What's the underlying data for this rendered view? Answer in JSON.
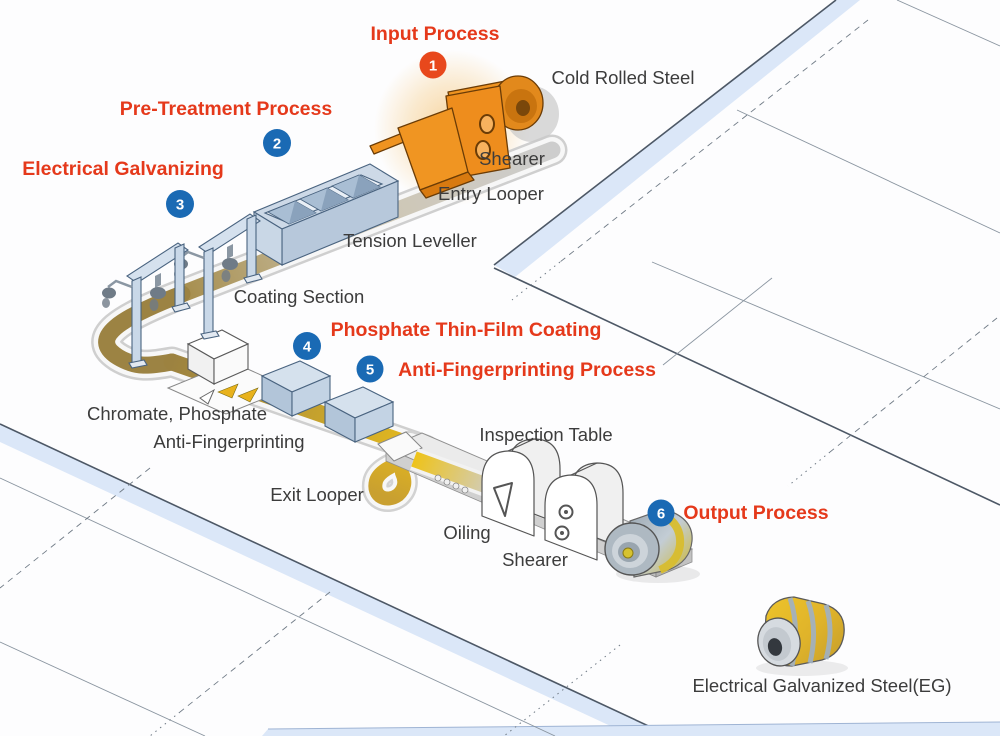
{
  "steps": [
    {
      "number": "1",
      "label": "Input Process",
      "badge_color": "#e8481c"
    },
    {
      "number": "2",
      "label": "Pre-Treatment Process",
      "badge_color": "#1a6ab4"
    },
    {
      "number": "3",
      "label": "Electrical Galvanizing",
      "badge_color": "#1a6ab4"
    },
    {
      "number": "4",
      "label": "Phosphate Thin-Film Coating",
      "badge_color": "#1a6ab4"
    },
    {
      "number": "5",
      "label": "Anti-Fingerprinting Process",
      "badge_color": "#1a6ab4"
    },
    {
      "number": "6",
      "label": "Output Process",
      "badge_color": "#1a6ab4"
    }
  ],
  "equipment": {
    "cold_rolled_steel": "Cold Rolled Steel",
    "shearer_entry": "Shearer",
    "entry_looper": "Entry Looper",
    "tension_leveller": "Tension Leveller",
    "coating_section": "Coating Section",
    "chromate_phosphate": "Chromate, Phosphate",
    "anti_fingerprinting": "Anti-Fingerprinting",
    "exit_looper": "Exit Looper",
    "inspection_table": "Inspection Table",
    "oiling": "Oiling",
    "shearer_exit": "Shearer",
    "eg_steel": "Electrical Galvanized Steel(EG)"
  },
  "colors": {
    "label_red": "#e5391b",
    "text_dark": "#3c3c3c",
    "badge_blue": "#1a6ab4",
    "badge_orange": "#e8481c",
    "machine_orange": "#ee8d1d",
    "machine_blue": "#c3d3e4",
    "strip_gold": "#eec31a",
    "strip_bronze": "#9d8648",
    "floor_band_blue": "#dbe7f8"
  }
}
